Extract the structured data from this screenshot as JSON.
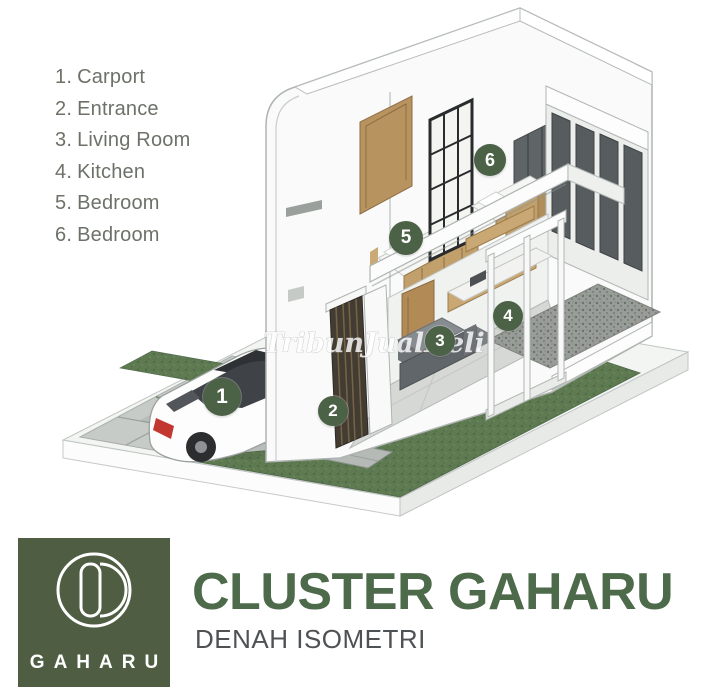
{
  "legend": {
    "items": [
      {
        "number": "1.",
        "label": "Carport"
      },
      {
        "number": "2.",
        "label": "Entrance"
      },
      {
        "number": "3.",
        "label": "Living Room"
      },
      {
        "number": "4.",
        "label": "Kitchen"
      },
      {
        "number": "5.",
        "label": "Bedroom"
      },
      {
        "number": "6.",
        "label": "Bedroom"
      }
    ]
  },
  "markers": [
    "1",
    "2",
    "3",
    "4",
    "5",
    "6"
  ],
  "watermark": {
    "text": "TribunJualBeli"
  },
  "branding": {
    "logo_text": "GAHARU",
    "title": "CLUSTER GAHARU",
    "subtitle": "DENAH ISOMETRI"
  },
  "colors": {
    "brand_green": "#4f5e42",
    "title_green": "#4d6a4b",
    "marker_green": "#4b6246",
    "legend_text": "#6d7268",
    "subtitle_gray": "#4f5254"
  }
}
